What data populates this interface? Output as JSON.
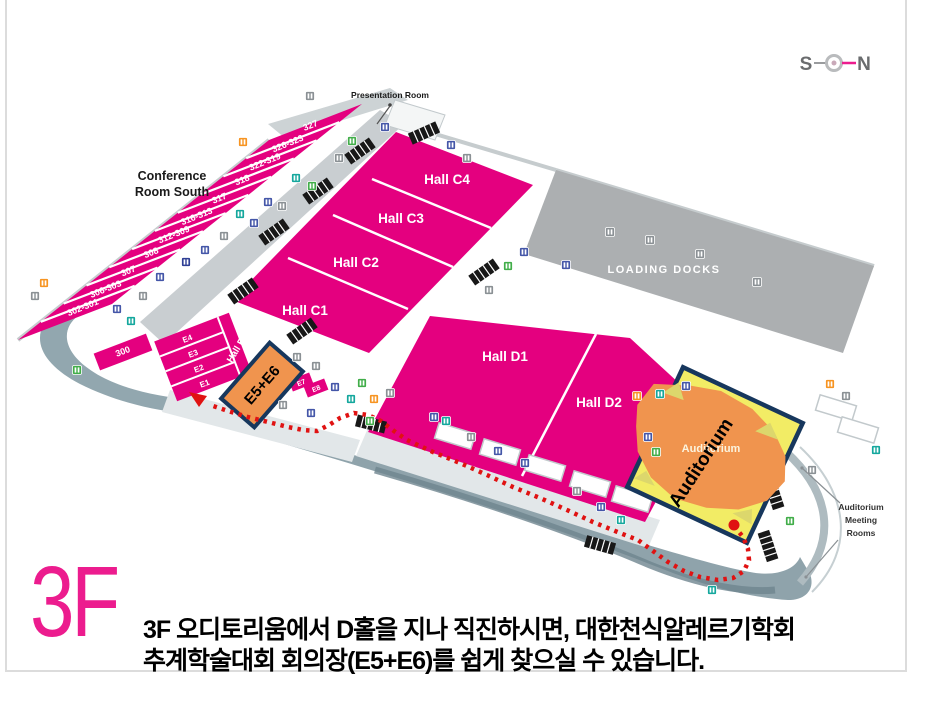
{
  "compass": {
    "west_label": "S",
    "east_label": "N"
  },
  "floor_badge": "3F",
  "caption": {
    "line1": "3F 오디토리움에서 D홀을 지나 직진하시면, 대한천식알레르기학회",
    "line2": "추계학술대회 회의장(E5+E6)를 쉽게 찾으실 수 있습니다."
  },
  "map": {
    "labels": {
      "conference_room_south_line1": "Conference",
      "conference_room_south_line2": "Room South",
      "presentation_room": "Presentation Room",
      "loading_docks": "LOADING DOCKS",
      "auditorium_meeting_rooms": [
        "Auditorium",
        "Meeting",
        "Rooms"
      ],
      "hall_e": "Hall E",
      "d2_annex": "1"
    },
    "halls_c": [
      {
        "name": "Hall C1",
        "x": 305,
        "y": 315
      },
      {
        "name": "Hall C2",
        "x": 356,
        "y": 267
      },
      {
        "name": "Hall C3",
        "x": 401,
        "y": 223
      },
      {
        "name": "Hall C4",
        "x": 447,
        "y": 184
      }
    ],
    "halls_d": [
      {
        "name": "Hall D1",
        "x": 505,
        "y": 361
      },
      {
        "name": "Hall D2",
        "x": 599,
        "y": 407
      }
    ],
    "conference_rooms": [
      "327",
      "326-323",
      "322-319",
      "318",
      "317",
      "316-313",
      "312-309",
      "308",
      "307",
      "306-303",
      "302-301"
    ],
    "conference_room_end": "300",
    "e_rooms": [
      "E4",
      "E3",
      "E2",
      "E1"
    ],
    "e_rooms_small": [
      {
        "label": "E7",
        "x": 301,
        "y": 382
      },
      {
        "label": "E8",
        "x": 316,
        "y": 388
      }
    ],
    "highlight_room": {
      "label": "E5+E6"
    },
    "auditorium": {
      "label": "Auditorium",
      "overlay_label": "Auditorium"
    },
    "route": {
      "start": [
        734,
        525
      ],
      "points": [
        [
          734,
          526
        ],
        [
          743,
          537
        ],
        [
          748,
          549
        ],
        [
          749,
          560
        ],
        [
          744,
          571
        ],
        [
          733,
          578
        ],
        [
          718,
          580
        ],
        [
          700,
          577
        ],
        [
          684,
          571
        ],
        [
          668,
          562
        ],
        [
          653,
          551
        ],
        [
          638,
          540
        ],
        [
          620,
          533
        ],
        [
          593,
          522
        ],
        [
          567,
          510
        ],
        [
          540,
          498
        ],
        [
          513,
          487
        ],
        [
          487,
          475
        ],
        [
          460,
          463
        ],
        [
          433,
          452
        ],
        [
          420,
          446
        ],
        [
          407,
          440
        ],
        [
          394,
          431
        ],
        [
          381,
          421
        ],
        [
          368,
          415
        ],
        [
          354,
          413
        ],
        [
          340,
          418
        ],
        [
          329,
          425
        ],
        [
          317,
          431
        ],
        [
          303,
          430
        ],
        [
          288,
          427
        ],
        [
          268,
          422
        ],
        [
          248,
          417
        ],
        [
          228,
          411
        ],
        [
          210,
          405
        ]
      ],
      "arrow": [
        [
          189,
          392
        ],
        [
          199,
          407
        ],
        [
          207,
          396
        ]
      ]
    },
    "icons": [
      {
        "x": 310,
        "y": 96,
        "c": "gray"
      },
      {
        "x": 243,
        "y": 142,
        "c": "orange"
      },
      {
        "x": 385,
        "y": 127,
        "c": "blue"
      },
      {
        "x": 352,
        "y": 141,
        "c": "green"
      },
      {
        "x": 339,
        "y": 158,
        "c": "gray"
      },
      {
        "x": 296,
        "y": 178,
        "c": "teal"
      },
      {
        "x": 312,
        "y": 186,
        "c": "green"
      },
      {
        "x": 268,
        "y": 202,
        "c": "blue"
      },
      {
        "x": 282,
        "y": 206,
        "c": "gray"
      },
      {
        "x": 240,
        "y": 214,
        "c": "teal"
      },
      {
        "x": 254,
        "y": 223,
        "c": "blue"
      },
      {
        "x": 224,
        "y": 236,
        "c": "gray"
      },
      {
        "x": 205,
        "y": 250,
        "c": "blue"
      },
      {
        "x": 186,
        "y": 262,
        "c": "navy"
      },
      {
        "x": 160,
        "y": 277,
        "c": "blue"
      },
      {
        "x": 143,
        "y": 296,
        "c": "gray"
      },
      {
        "x": 117,
        "y": 309,
        "c": "blue"
      },
      {
        "x": 44,
        "y": 283,
        "c": "orange"
      },
      {
        "x": 35,
        "y": 296,
        "c": "gray"
      },
      {
        "x": 77,
        "y": 370,
        "c": "green"
      },
      {
        "x": 131,
        "y": 321,
        "c": "teal"
      },
      {
        "x": 451,
        "y": 145,
        "c": "blue"
      },
      {
        "x": 467,
        "y": 158,
        "c": "gray"
      },
      {
        "x": 489,
        "y": 290,
        "c": "gray"
      },
      {
        "x": 508,
        "y": 266,
        "c": "green"
      },
      {
        "x": 524,
        "y": 252,
        "c": "blue"
      },
      {
        "x": 566,
        "y": 265,
        "c": "blue"
      },
      {
        "x": 610,
        "y": 232,
        "c": "gray"
      },
      {
        "x": 650,
        "y": 240,
        "c": "gray"
      },
      {
        "x": 757,
        "y": 282,
        "c": "gray"
      },
      {
        "x": 700,
        "y": 254,
        "c": "gray"
      },
      {
        "x": 297,
        "y": 357,
        "c": "gray"
      },
      {
        "x": 316,
        "y": 366,
        "c": "gray"
      },
      {
        "x": 335,
        "y": 387,
        "c": "blue"
      },
      {
        "x": 362,
        "y": 383,
        "c": "green"
      },
      {
        "x": 351,
        "y": 399,
        "c": "teal"
      },
      {
        "x": 374,
        "y": 399,
        "c": "orange"
      },
      {
        "x": 390,
        "y": 393,
        "c": "gray"
      },
      {
        "x": 311,
        "y": 413,
        "c": "blue"
      },
      {
        "x": 283,
        "y": 405,
        "c": "gray"
      },
      {
        "x": 370,
        "y": 421,
        "c": "green"
      },
      {
        "x": 434,
        "y": 417,
        "c": "blue"
      },
      {
        "x": 446,
        "y": 421,
        "c": "teal"
      },
      {
        "x": 471,
        "y": 437,
        "c": "gray"
      },
      {
        "x": 498,
        "y": 451,
        "c": "blue"
      },
      {
        "x": 525,
        "y": 463,
        "c": "blue"
      },
      {
        "x": 577,
        "y": 491,
        "c": "gray"
      },
      {
        "x": 601,
        "y": 507,
        "c": "blue"
      },
      {
        "x": 621,
        "y": 520,
        "c": "teal"
      },
      {
        "x": 637,
        "y": 396,
        "c": "orange"
      },
      {
        "x": 660,
        "y": 394,
        "c": "teal"
      },
      {
        "x": 686,
        "y": 386,
        "c": "blue"
      },
      {
        "x": 648,
        "y": 437,
        "c": "blue"
      },
      {
        "x": 656,
        "y": 452,
        "c": "green"
      },
      {
        "x": 830,
        "y": 384,
        "c": "orange"
      },
      {
        "x": 846,
        "y": 396,
        "c": "gray"
      },
      {
        "x": 876,
        "y": 450,
        "c": "teal"
      },
      {
        "x": 790,
        "y": 521,
        "c": "green"
      },
      {
        "x": 812,
        "y": 470,
        "c": "gray"
      },
      {
        "x": 712,
        "y": 590,
        "c": "teal"
      }
    ],
    "escalators": [
      [
        360,
        151,
        -35
      ],
      [
        318,
        191,
        -35
      ],
      [
        274,
        232,
        -35
      ],
      [
        243,
        291,
        -35
      ],
      [
        302,
        331,
        -35
      ],
      [
        371,
        424,
        14
      ],
      [
        484,
        272,
        -35
      ],
      [
        424,
        133,
        -24
      ],
      [
        768,
        546,
        72
      ],
      [
        774,
        494,
        72
      ],
      [
        600,
        545,
        16
      ]
    ],
    "pavilions": [
      [
        455,
        436
      ],
      [
        500,
        452
      ],
      [
        545,
        468
      ],
      [
        590,
        484
      ],
      [
        632,
        499
      ],
      [
        836,
        408
      ],
      [
        858,
        430
      ]
    ],
    "colors": {
      "magenta": "#E4007F",
      "dock_gray": "#ACAFB1",
      "yellow": "#F2EC65",
      "orange_highlight": "#F0944E",
      "navy": "#17375D",
      "route_red": "#E01212",
      "promenade": "#92A7AF",
      "corridor": "#C9CED1",
      "band": "#E2E7E9",
      "icon_blue": "#4456A8",
      "icon_green": "#41AD49",
      "icon_teal": "#14A79D",
      "icon_orange": "#F79421",
      "icon_gray": "#8A9094",
      "icon_navy": "#2F3F95"
    }
  }
}
